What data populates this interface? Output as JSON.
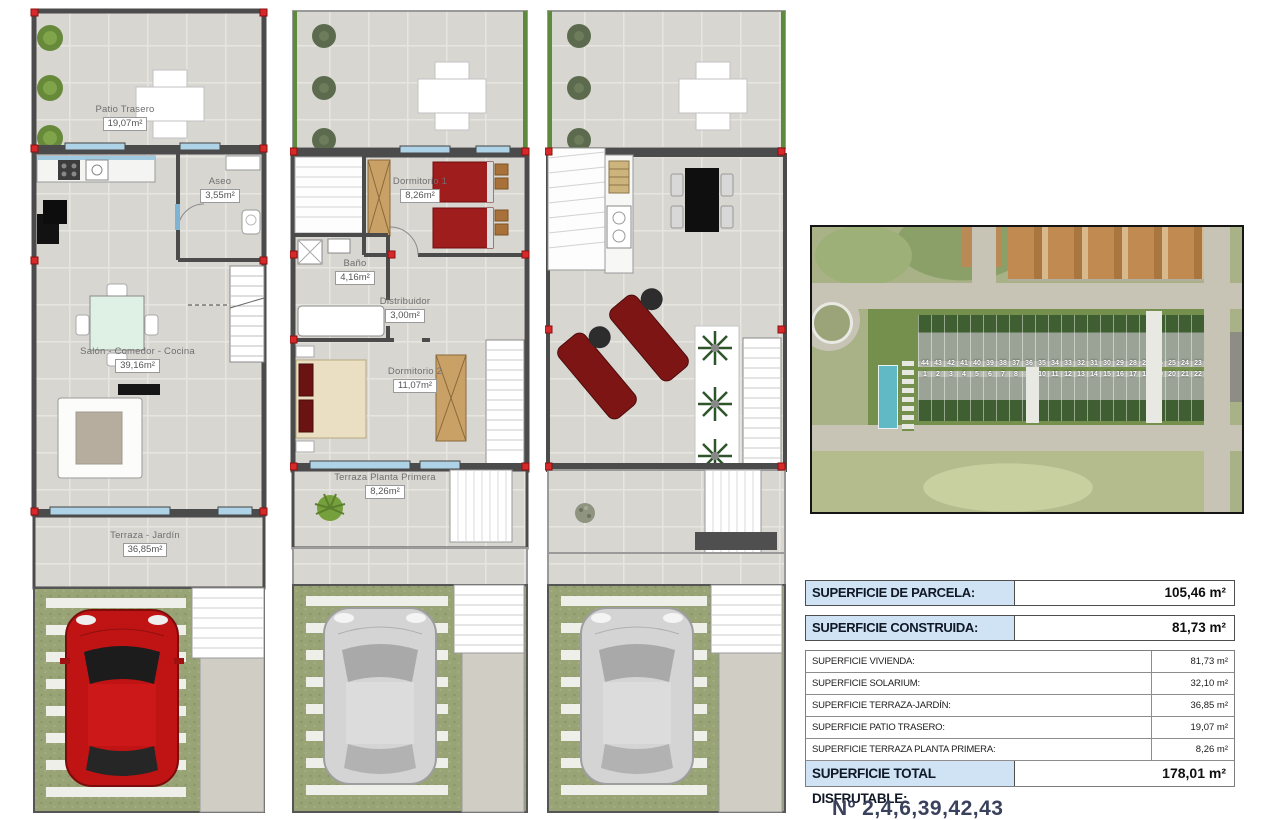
{
  "floor_plans": {
    "ground": {
      "rooms": [
        {
          "name": "Patio Trasero",
          "area": "19,07m²"
        },
        {
          "name": "Aseo",
          "area": "3,55m²"
        },
        {
          "name": "Salón - Comedor - Cocina",
          "area": "39,16m²"
        },
        {
          "name": "Terraza - Jardín",
          "area": "36,85m²"
        }
      ]
    },
    "first": {
      "rooms": [
        {
          "name": "Dormitorio 1",
          "area": "8,26m²"
        },
        {
          "name": "Baño",
          "area": "4,16m²"
        },
        {
          "name": "Distribuidor",
          "area": "3,00m²"
        },
        {
          "name": "Dormitorio 2",
          "area": "11,07m²"
        },
        {
          "name": "Terraza Planta Primera",
          "area": "8,26m²"
        }
      ]
    },
    "solarium": {
      "rooms": []
    }
  },
  "site_map": {
    "top_row_numbers": [
      "44",
      "43",
      "42",
      "41",
      "40",
      "39",
      "38",
      "37",
      "36",
      "35",
      "34",
      "33",
      "32",
      "31",
      "30",
      "29",
      "28",
      "27",
      "26",
      "25",
      "24",
      "23"
    ],
    "bottom_row_numbers": [
      "1",
      "2",
      "3",
      "4",
      "5",
      "6",
      "7",
      "8",
      "9",
      "10",
      "11",
      "12",
      "13",
      "14",
      "15",
      "16",
      "17",
      "18",
      "19",
      "20",
      "21",
      "22"
    ]
  },
  "area_table": {
    "highlight_rows": [
      {
        "label": "SUPERFICIE DE PARCELA:",
        "value": "105,46 m²"
      },
      {
        "label": "SUPERFICIE CONSTRUIDA:",
        "value": "81,73 m²"
      }
    ],
    "detail_rows": [
      {
        "label": "SUPERFICIE VIVIENDA:",
        "value": "81,73 m²"
      },
      {
        "label": "SUPERFICIE SOLARIUM:",
        "value": "32,10 m²"
      },
      {
        "label": "SUPERFICIE TERRAZA-JARDÍN:",
        "value": "36,85 m²"
      },
      {
        "label": "SUPERFICIE PATIO TRASERO:",
        "value": "19,07 m²"
      },
      {
        "label": "SUPERFICIE TERRAZA PLANTA PRIMERA:",
        "value": "8,26 m²"
      }
    ],
    "total_row": {
      "label": "SUPERFICIE TOTAL DISFRUTABLE:",
      "value": "178,01 m²"
    }
  },
  "footer": {
    "units_label": "Nº 2,4,6,39,42,43"
  },
  "colors": {
    "table_header_bg": "#cfe3f5",
    "wall": "#4b4b4b",
    "marker_red": "#d62a2a",
    "car_red": "#c01414",
    "bed_red": "#a01d1d",
    "wood": "#c9a066",
    "grass": "#98a376",
    "tile": "#d8d6d1",
    "pool_blue": "#62b9c6"
  }
}
